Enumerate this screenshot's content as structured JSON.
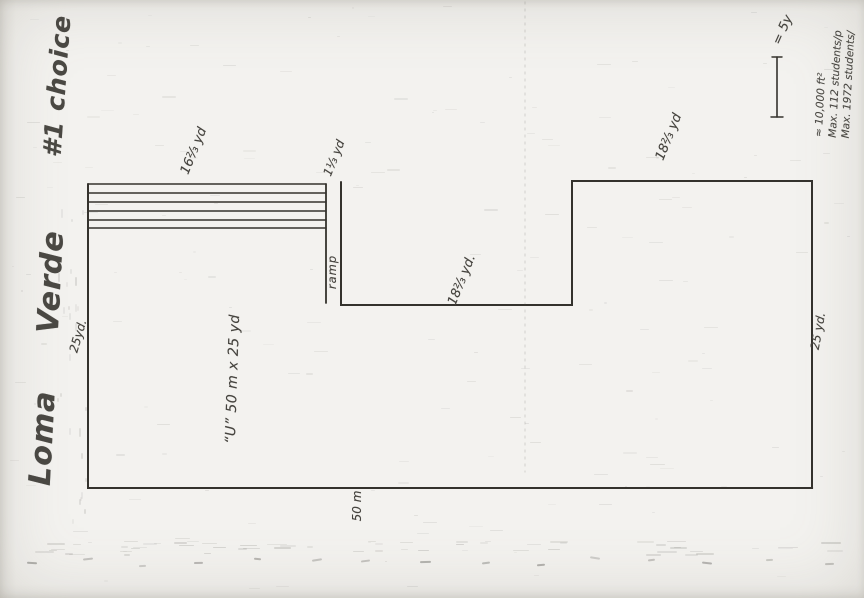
{
  "header": {
    "title": "Loma Verde",
    "choice": "#1 choice"
  },
  "legend": {
    "scale_label": "= 5y",
    "notes": [
      "≈ 10,000 ft²",
      "Max. 112 students/p",
      "Max. 1972 students/"
    ]
  },
  "plan": {
    "dimensions": {
      "bleachers": "16⅔ yd",
      "ramp_width": "1⅓ yd",
      "ramp": "ramp",
      "notch": "18⅔ yd.",
      "east_wing": "18⅔ yd",
      "right_side": "25 yd.",
      "left_side": "25yd.",
      "pool": "“U”  50 m x 25 yd",
      "bottom": "50 m"
    }
  }
}
